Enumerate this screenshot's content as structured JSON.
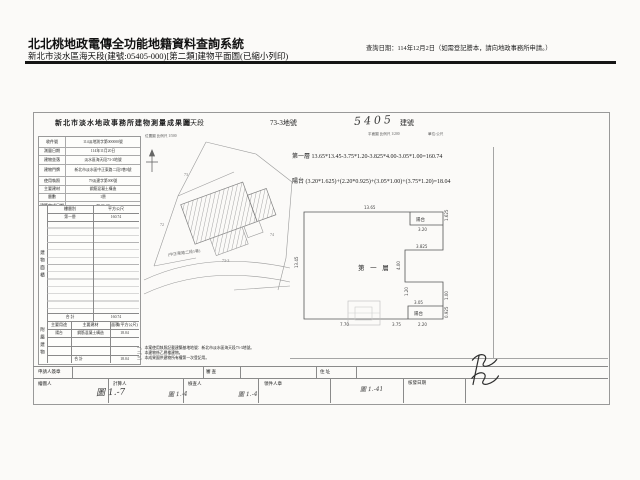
{
  "colors": {
    "rule": "#151515",
    "scan_line": "#8a8a8a",
    "ink": "#1a1a1a"
  },
  "app": {
    "title": "北北桃地政電傳全功能地籍資料查詢系統",
    "subtitle": "新北市淡水區海天段(建號:05405-000)[第二類]建物平面圖(已縮小列印)",
    "query_date": "查詢日期：114年12月2日（如需登記謄本，請向地政事務所申請。）"
  },
  "form": {
    "title": "新北市淡水地政事務所建物測量成果圖",
    "section_name": "海天段",
    "lot_no": "73-3地號",
    "building_no_hand": "5405",
    "building_no_label": "建號",
    "captions": {
      "site": "位置圖 比例尺 1/500",
      "plan": "平面圖 比例尺 1/200",
      "unit": "單位:公尺"
    },
    "info_rows": [
      {
        "label": "收件號",
        "value": "114淡地測字第000000號"
      },
      {
        "label": "測量日期",
        "value": "114年11月20日"
      },
      {
        "label": "建物坐落",
        "value": "淡水區海天段73-3地號"
      },
      {
        "label": "建物門牌",
        "value": "新北市淡水區中正東路二段5巷0號"
      },
      {
        "label": "使用執照",
        "value": "79淡建字第000號"
      },
      {
        "label": "主要建材",
        "value": "鋼筋混凝土構造"
      },
      {
        "label": "層數",
        "value": "1層"
      },
      {
        "label": "建築完成日期",
        "value": "79.06.30"
      }
    ],
    "area_table": {
      "header": {
        "floor": "樓層別",
        "area": "平方公尺"
      },
      "rows": [
        {
          "floor": "第一層",
          "area": "160.74"
        }
      ],
      "total_label": "合 計",
      "total_value": "160.74",
      "vertical": "建物面積"
    },
    "annex_table": {
      "header": {
        "use": "主要用途",
        "material": "主要建材",
        "area": "面積(平方公尺)"
      },
      "rows": [
        {
          "use": "陽台",
          "material": "鋼筋混凝土構造",
          "area": "18.04"
        }
      ],
      "total_label": "合 計",
      "total_value": "18.04",
      "vertical": "附屬建物"
    },
    "formulas": {
      "floor1": "第一層 13.65*13.45-3.75*1.20-3.825*4.00-3.05*1.00=160.74",
      "balcony": "陽台 (3.20*1.625)+(2.20*0.925)+(3.05*1.00)+(3.75*1.20)=18.04"
    },
    "notes": [
      "一、本案使用執照記載建築基地地號：新北市淡水區海天段73-3地號。",
      "二、本建物係乙層樓建物。",
      "三、本成果圖供建物所有權第一次登記用。"
    ],
    "footer": {
      "row1": [
        "申請人簽章",
        "審 查",
        "住 址"
      ],
      "row2": [
        "繪圖人",
        "計算人",
        "檢查人",
        "領件人章",
        "核發日期"
      ]
    },
    "hand_marks": [
      "圖 1.-7",
      "圖 1.-4",
      "圖 1.-4",
      "圖 1.-41"
    ]
  },
  "site": {
    "road_label": "(中正東路二段5巷)",
    "lots": [
      "73",
      "73-3",
      "74",
      "72"
    ]
  },
  "plan": {
    "label_floor": "第 一 層",
    "balcony_top": "陽台",
    "balcony_bottom": "陽台",
    "dims": [
      "13.65",
      "13.45",
      "3.20",
      "1.625",
      "3.825",
      "4.00",
      "3.05",
      "1.00",
      "3.75",
      "1.20",
      "2.20",
      "0.925",
      "7.70"
    ]
  }
}
